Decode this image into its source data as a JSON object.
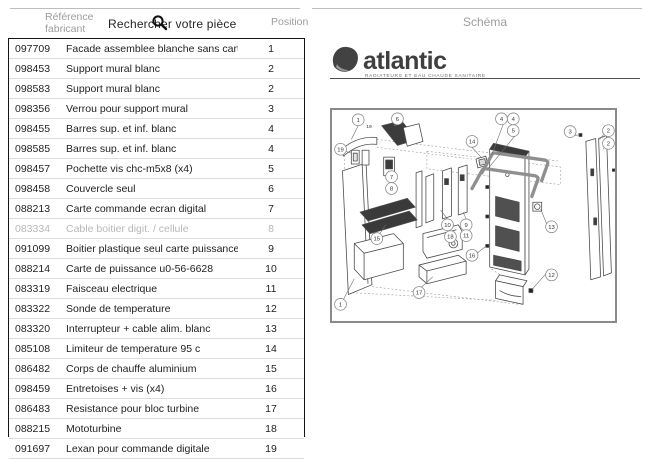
{
  "header": {
    "ref_label": "Référence fabricant",
    "search_placeholder": "Rechercher votre pièce",
    "position_label": "Position",
    "schema_label": "Schéma"
  },
  "logo": {
    "brand": "atlantic",
    "tagline": "RADIATEURS ET EAU CHAUDE SANITAIRE"
  },
  "icons": {
    "search_icon": "magnifying-glass"
  },
  "colors": {
    "muted_text": "#9c9c9c",
    "dark_text": "#1f1f1f",
    "logo_gray": "#424242",
    "table_border": "#141414",
    "diagram_border": "#8a8a8a"
  },
  "table": {
    "rows": [
      {
        "ref": "097709",
        "label": "Facade assemblee blanche sans carte elec",
        "pos": "1",
        "muted": false
      },
      {
        "ref": "098453",
        "label": "Support mural blanc",
        "pos": "2",
        "muted": false
      },
      {
        "ref": "098583",
        "label": "Support mural blanc",
        "pos": "2",
        "muted": false
      },
      {
        "ref": "098356",
        "label": "Verrou pour support mural",
        "pos": "3",
        "muted": false
      },
      {
        "ref": "098455",
        "label": "Barres sup. et inf. blanc",
        "pos": "4",
        "muted": false
      },
      {
        "ref": "098585",
        "label": "Barres sup. et inf. blanc",
        "pos": "4",
        "muted": false
      },
      {
        "ref": "098457",
        "label": "Pochette vis chc-m5x8 (x4)",
        "pos": "5",
        "muted": false
      },
      {
        "ref": "098458",
        "label": "Couvercle seul",
        "pos": "6",
        "muted": false
      },
      {
        "ref": "088213",
        "label": "Carte commande ecran digital",
        "pos": "7",
        "muted": false
      },
      {
        "ref": "083334",
        "label": "Cable boitier digit. / cellule",
        "pos": "8",
        "muted": true
      },
      {
        "ref": "091099",
        "label": "Boitier plastique seul carte puissance",
        "pos": "9",
        "muted": false
      },
      {
        "ref": "088214",
        "label": "Carte de puissance u0-56-6628",
        "pos": "10",
        "muted": false
      },
      {
        "ref": "083319",
        "label": "Faisceau electrique",
        "pos": "11",
        "muted": false
      },
      {
        "ref": "083322",
        "label": "Sonde de temperature",
        "pos": "12",
        "muted": false
      },
      {
        "ref": "083320",
        "label": "Interrupteur + cable alim. blanc",
        "pos": "13",
        "muted": false
      },
      {
        "ref": "085108",
        "label": "Limiteur de temperature 95 c",
        "pos": "14",
        "muted": false
      },
      {
        "ref": "086482",
        "label": "Corps de chauffe aluminium",
        "pos": "15",
        "muted": false
      },
      {
        "ref": "098459",
        "label": "Entretoises + vis (x4)",
        "pos": "16",
        "muted": false
      },
      {
        "ref": "086483",
        "label": "Resistance pour bloc turbine",
        "pos": "17",
        "muted": false
      },
      {
        "ref": "088215",
        "label": "Mototurbine",
        "pos": "18",
        "muted": false
      },
      {
        "ref": "091697",
        "label": "Lexan pour commande digitale",
        "pos": "19",
        "muted": false
      }
    ]
  },
  "diagram": {
    "callouts": [
      {
        "n": "1",
        "x": 26,
        "y": 10
      },
      {
        "n": "19",
        "x": 37,
        "y": 16,
        "plain": true
      },
      {
        "n": "6",
        "x": 66,
        "y": 9
      },
      {
        "n": "19",
        "x": 8,
        "y": 40
      },
      {
        "n": "14",
        "x": 142,
        "y": 32
      },
      {
        "n": "4",
        "x": 172,
        "y": 9
      },
      {
        "n": "4",
        "x": 184,
        "y": 9
      },
      {
        "n": "5",
        "x": 184,
        "y": 21
      },
      {
        "n": "3",
        "x": 242,
        "y": 22
      },
      {
        "n": "2",
        "x": 281,
        "y": 21
      },
      {
        "n": "2",
        "x": 281,
        "y": 34
      },
      {
        "n": "7",
        "x": 60,
        "y": 68
      },
      {
        "n": "8",
        "x": 60,
        "y": 80
      },
      {
        "n": "10",
        "x": 117,
        "y": 117
      },
      {
        "n": "9",
        "x": 136,
        "y": 117
      },
      {
        "n": "11",
        "x": 136,
        "y": 128
      },
      {
        "n": "13",
        "x": 223,
        "y": 119
      },
      {
        "n": "15",
        "x": 45,
        "y": 131
      },
      {
        "n": "18",
        "x": 120,
        "y": 129
      },
      {
        "n": "16",
        "x": 142,
        "y": 148
      },
      {
        "n": "12",
        "x": 223,
        "y": 168
      },
      {
        "n": "17",
        "x": 88,
        "y": 186
      },
      {
        "n": "1",
        "x": 8,
        "y": 198
      }
    ]
  }
}
